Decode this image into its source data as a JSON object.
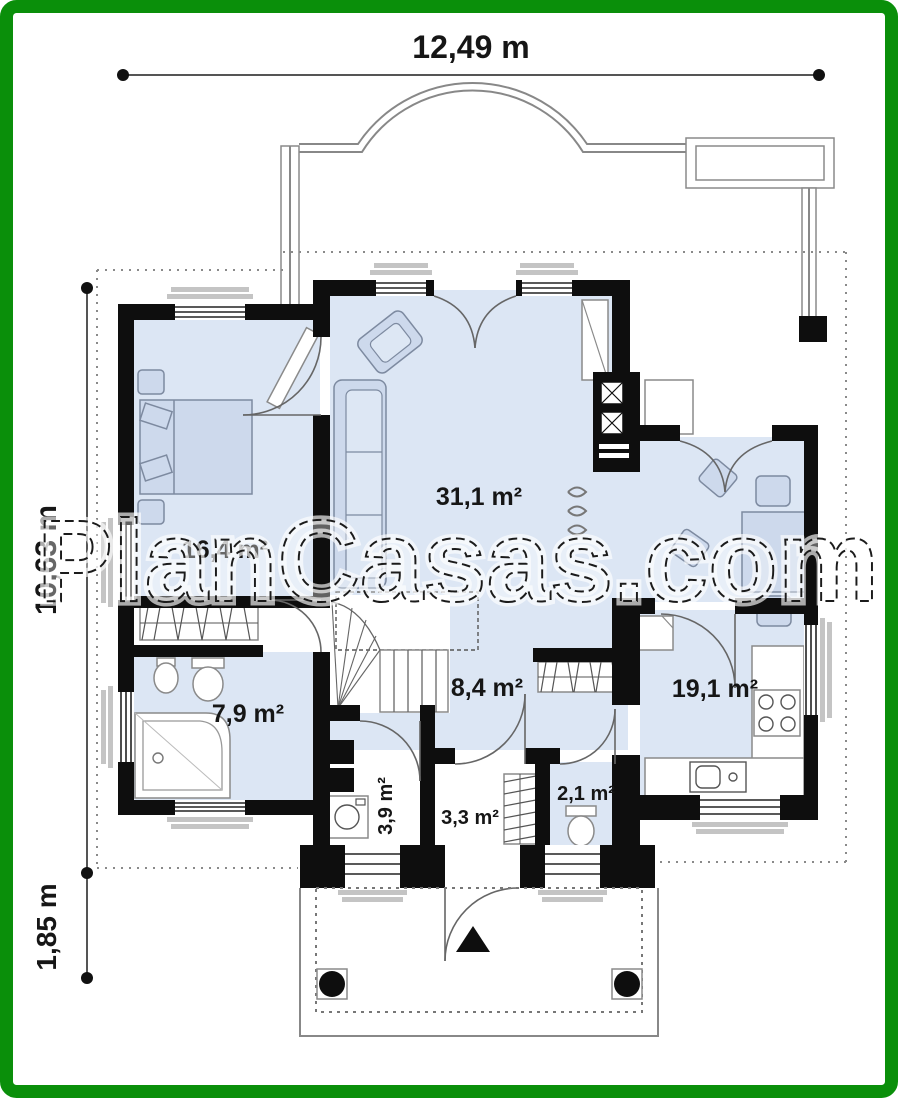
{
  "watermark": {
    "text": "PlanCasas.com"
  },
  "dimensions": {
    "total_width": "12,49 m",
    "main_depth": "10,63 m",
    "porch_depth": "1,85 m"
  },
  "rooms": {
    "living_area": "31,1 m²",
    "bedroom_area": "16,4 m²",
    "bathroom_area": "7,9 m²",
    "hall_area": "8,4 m²",
    "kitchen_area": "19,1 m²",
    "utility_area": "3,9 m²",
    "vestibule_area": "3,3 m²",
    "wc_area": "2,1 m²"
  },
  "colors": {
    "frame_green": "#0a8f0a",
    "wall_black": "#0e0e0e",
    "room_fill_blue": "#dce6f4",
    "furniture_fill": "#cdd9ec",
    "line_gray": "#888888",
    "sill_gray": "#c4c4c4",
    "background": "#ffffff"
  }
}
